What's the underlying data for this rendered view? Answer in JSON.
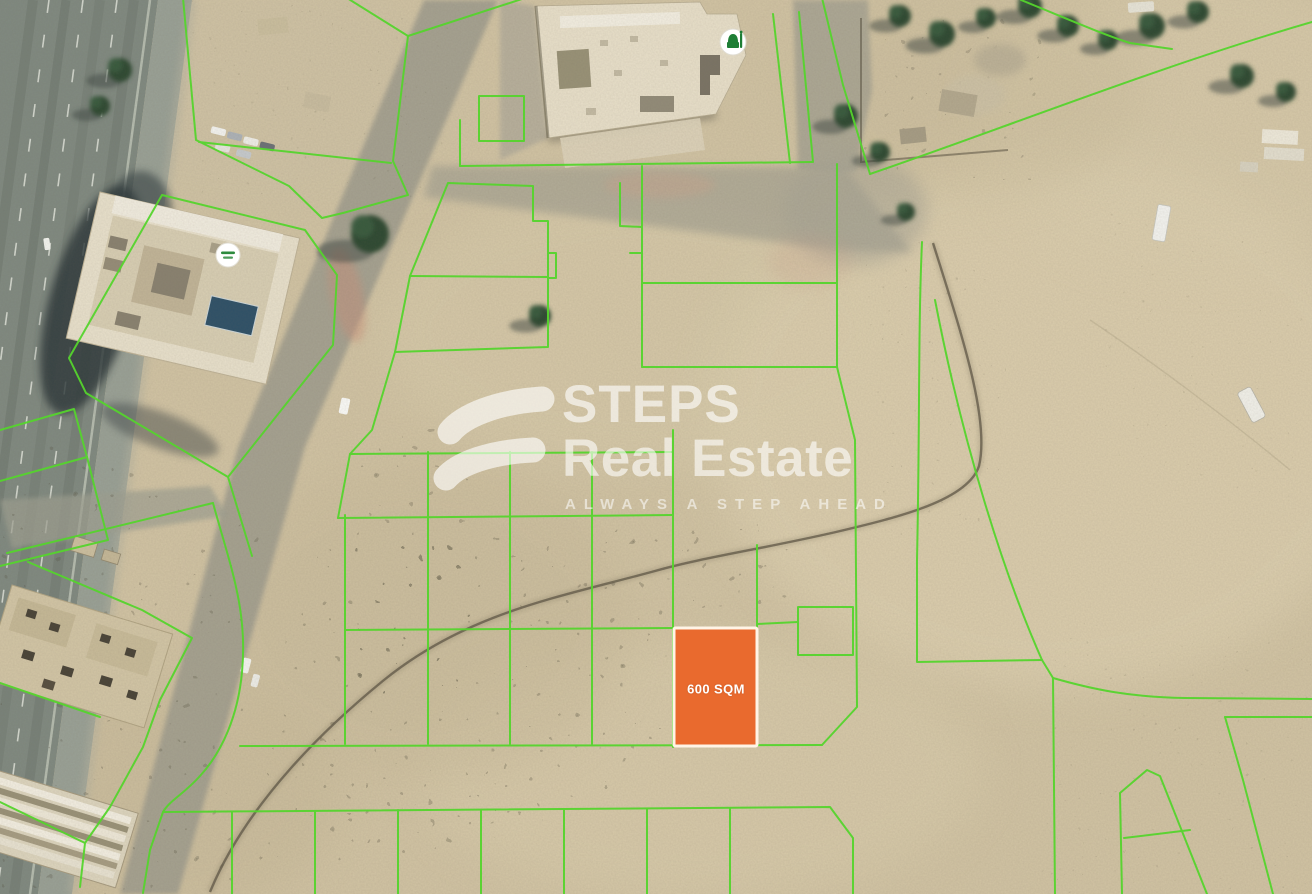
{
  "map": {
    "watermark": {
      "brand_top": "STEPS",
      "brand_bottom": "Real Estate",
      "tagline": "ALWAYS A STEP AHEAD"
    },
    "highlight_plot": {
      "label": "600 SQM",
      "fill": "#E96A2E",
      "border": "#FFF4E6"
    },
    "plot_line_color": "#55D42D",
    "markers": [
      {
        "name": "mosque-icon"
      },
      {
        "name": "place-label-marker"
      }
    ]
  }
}
